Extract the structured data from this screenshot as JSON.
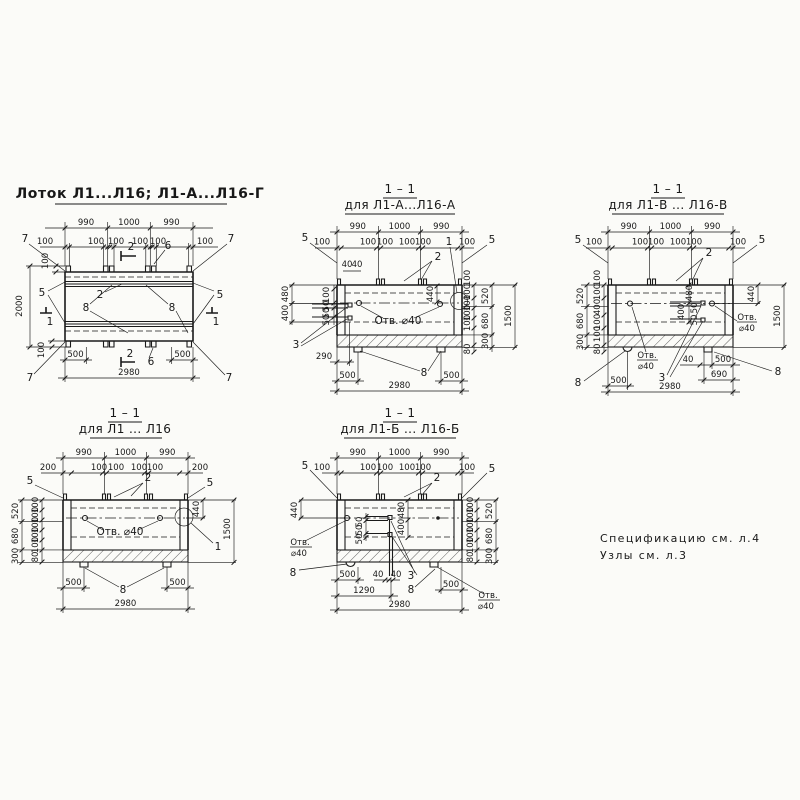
{
  "t": {
    "plan": "Лоток Л1...Л16; Л1-А...Л16-Г",
    "sec": "1 – 1",
    "fa": "для Л1-А...Л16-А",
    "fv": "для Л1-В ... Л16-В",
    "fp": "для Л1 ... Л16",
    "fb": "для Л1-Б ... Л16-Б"
  },
  "d": {
    "v40": "40",
    "v50": "50",
    "v80": "80",
    "v100": "100",
    "v200": "200",
    "v290": "290",
    "v300": "300",
    "v400": "400",
    "v440": "440",
    "v480": "480",
    "v500": "500",
    "v520": "520",
    "v680": "680",
    "v690": "690",
    "v990": "990",
    "v1000": "1000",
    "v1290": "1290",
    "v1500": "1500",
    "v2000": "2000",
    "v2980": "2980"
  },
  "p": {
    "n1": "1",
    "n2": "2",
    "n3": "3",
    "n5": "5",
    "n6": "6",
    "n7": "7",
    "n8": "8"
  },
  "n": {
    "hole": "Отв. ⌀40",
    "otv": "Отв.",
    "d40": "⌀40",
    "spec": "Спецификацию см. л.4",
    "uzly": "Узлы см. л.3"
  },
  "colors": {
    "ink": "#1a1a1a",
    "paper": "#fbfbf8"
  }
}
